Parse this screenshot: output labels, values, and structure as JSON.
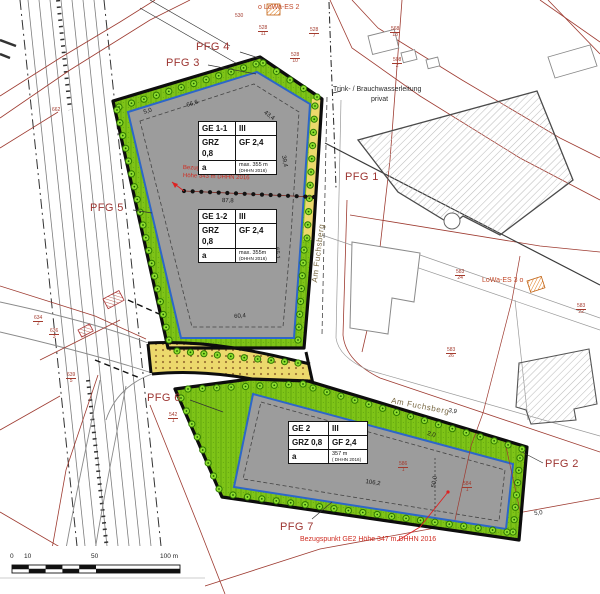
{
  "colors": {
    "site_green": "#7ec417",
    "area_gray": "#9c9c9c",
    "build_line_blue": "#2c66c9",
    "road_yellow": "#ecd96c",
    "boundary_black": "#0d0d0d",
    "cadastre_red": "#9e3b31",
    "pfg_label_red": "#9c3430",
    "annotation_red": "#cf2b20"
  },
  "pfg": {
    "pfg1": "PFG 1",
    "pfg2": "PFG 2",
    "pfg3": "PFG 3",
    "pfg4": "PFG 4",
    "pfg5": "PFG 5",
    "pfg6": "PFG 6",
    "pfg7": "PFG 7"
  },
  "annotations": {
    "lowa_top": "o LoWa-ES 2",
    "lowa_right": "LoWa-ES 3 o",
    "water_line1": "Trink- / Brauchwasserleitung",
    "water_line2": "privat",
    "street_upper": "Am Fuchsberg",
    "street_lower": "Am Fuchsberg",
    "ref_upper_line1": "Bezugspunkt GE 1-1 und GE 1-2",
    "ref_upper_line2": "Höhe 343 m DHHN 2016",
    "ref_lower": "Bezugspunkt GE2 Höhe 347 m DHHN 2016"
  },
  "ge_tables": {
    "ge11": {
      "name": "GE 1-1",
      "storeys": "III",
      "grz": "GRZ 0,8",
      "gf": "GF 2,4",
      "ref": "a",
      "height": "max. 355 m",
      "datum": "(DHHN 2016)"
    },
    "ge12": {
      "name": "GE 1-2",
      "storeys": "III",
      "grz": "GRZ 0,8",
      "gf": "GF 2,4",
      "ref": "a",
      "height": "max. 355m",
      "datum": "(DHHN 2016)"
    },
    "ge2": {
      "name": "GE 2",
      "storeys": "III",
      "grz": "GRZ 0,8",
      "gf": "GF 2,4",
      "ref": "a",
      "height": "357 m",
      "datum": "( DHHN 2016)"
    }
  },
  "measurements": [
    {
      "text": "66,6"
    },
    {
      "text": "43,4"
    },
    {
      "text": "5,0"
    },
    {
      "text": "39,4"
    },
    {
      "text": "87,8"
    },
    {
      "text": "65,1"
    },
    {
      "text": "60,4"
    },
    {
      "text": "3,9"
    },
    {
      "text": "2,0"
    },
    {
      "text": "106,2"
    },
    {
      "text": "50,0"
    },
    {
      "text": "5,0"
    }
  ],
  "parcel_numbers": [
    {
      "num": "530",
      "den": ""
    },
    {
      "num": "528",
      "den": "11"
    },
    {
      "num": "528",
      "den": "7"
    },
    {
      "num": "568",
      "den": "13"
    },
    {
      "num": "528",
      "den": "10"
    },
    {
      "num": "508",
      "den": "2"
    },
    {
      "num": "662",
      "den": ""
    },
    {
      "num": "583",
      "den": "24"
    },
    {
      "num": "583",
      "den": "26"
    },
    {
      "num": "583",
      "den": "22"
    },
    {
      "num": "634",
      "den": "2"
    },
    {
      "num": "636",
      "den": "3"
    },
    {
      "num": "639",
      "den": "5"
    },
    {
      "num": "542",
      "den": "1"
    },
    {
      "num": "586",
      "den": "1"
    },
    {
      "num": "584",
      "den": "1"
    }
  ],
  "scale_bar": {
    "t0": "0",
    "t1": "10",
    "t2": "50",
    "t3": "100 m"
  }
}
